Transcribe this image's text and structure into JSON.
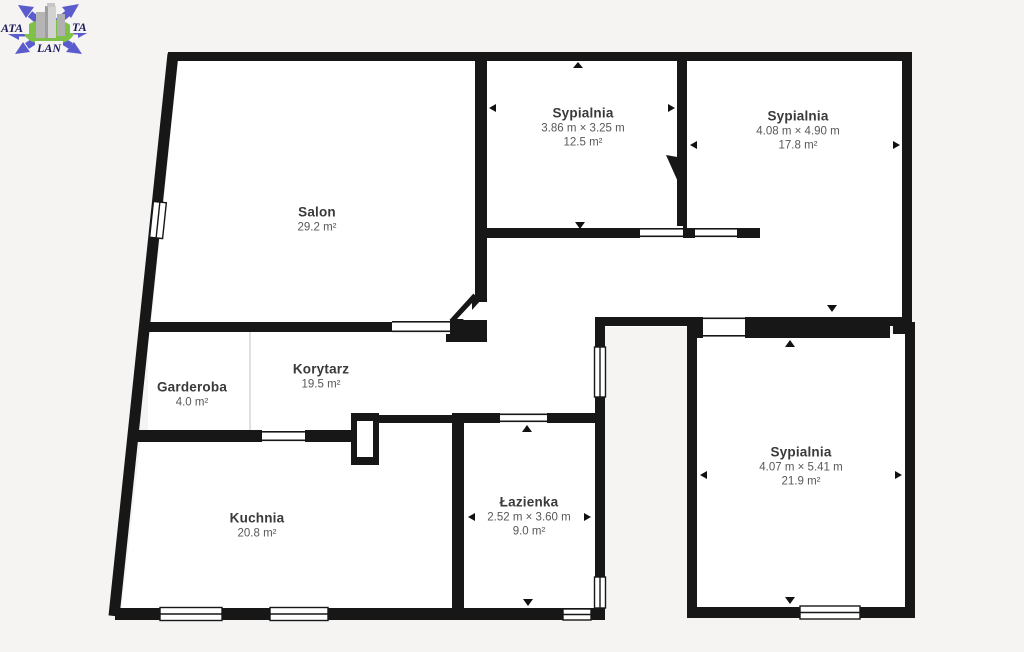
{
  "page": {
    "background": "#f5f4f2",
    "wall_color": "#171717",
    "room_fill": "#ffffff"
  },
  "logo": {
    "text_left": "ATA",
    "text_right": "TA",
    "text_bottom": "LAN",
    "arrow_color": "#5a5bcd",
    "ellipse_color": "#7fc148",
    "building_color": "#b5b5b5",
    "text_color": "#1a1a5c"
  },
  "rooms": [
    {
      "id": "salon",
      "name": "Salon",
      "dimensions": "",
      "area": "29.2 m²"
    },
    {
      "id": "sypialnia-1",
      "name": "Sypialnia",
      "dimensions": "3.86 m × 3.25 m",
      "area": "12.5 m²"
    },
    {
      "id": "sypialnia-2",
      "name": "Sypialnia",
      "dimensions": "4.08 m × 4.90 m",
      "area": "17.8 m²"
    },
    {
      "id": "garderoba",
      "name": "Garderoba",
      "dimensions": "",
      "area": "4.0 m²"
    },
    {
      "id": "korytarz",
      "name": "Korytarz",
      "dimensions": "",
      "area": "19.5 m²"
    },
    {
      "id": "kuchnia",
      "name": "Kuchnia",
      "dimensions": "",
      "area": "20.8 m²"
    },
    {
      "id": "lazienka",
      "name": "Łazienka",
      "dimensions": "2.52 m × 3.60 m",
      "area": "9.0 m²"
    },
    {
      "id": "sypialnia-3",
      "name": "Sypialnia",
      "dimensions": "4.07 m × 5.41 m",
      "area": "21.9 m²"
    }
  ]
}
